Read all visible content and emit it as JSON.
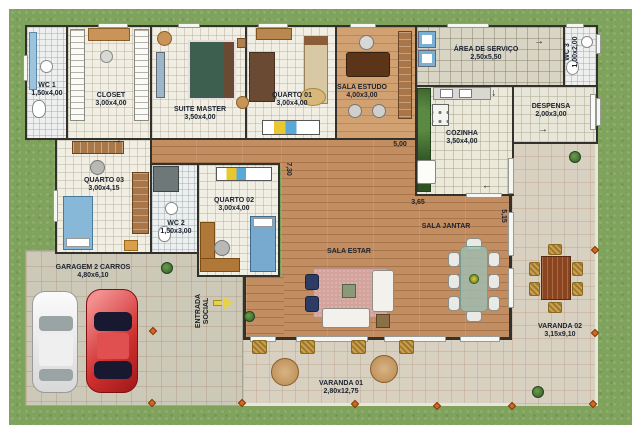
{
  "plan_type": "residential-floor-plan",
  "rooms": [
    {
      "id": "wc1",
      "name": "WC 1",
      "dims": "1,50x4,00"
    },
    {
      "id": "closet",
      "name": "CLOSET",
      "dims": "3,00x4,00"
    },
    {
      "id": "suite",
      "name": "SUITE MASTER",
      "dims": "3,50x4,00"
    },
    {
      "id": "quarto01",
      "name": "QUARTO 01",
      "dims": "3,00x4,00"
    },
    {
      "id": "estudo",
      "name": "SALA ESTUDO",
      "dims": "4,00x3,00"
    },
    {
      "id": "servico",
      "name": "ÁREA DE SERVIÇO",
      "dims": "2,50x5,50"
    },
    {
      "id": "wc3",
      "name": "WC 3",
      "dims": "1,00x2,00"
    },
    {
      "id": "despensa",
      "name": "DESPENSA",
      "dims": "2,00x3,00"
    },
    {
      "id": "cozinha",
      "name": "COZINHA",
      "dims": "3,50x4,00"
    },
    {
      "id": "quarto03",
      "name": "QUARTO 03",
      "dims": "3,00x4,15"
    },
    {
      "id": "wc2",
      "name": "WC 2",
      "dims": "1,50x3,00"
    },
    {
      "id": "quarto02",
      "name": "QUARTO 02",
      "dims": "3,00x4,00"
    },
    {
      "id": "garagem",
      "name": "GARAGEM 2 CARROS",
      "dims": "4,80x6,10"
    },
    {
      "id": "sala-estar",
      "name": "SALA ESTAR",
      "dims": ""
    },
    {
      "id": "sala-jantar",
      "name": "SALA JANTAR",
      "dims": ""
    },
    {
      "id": "varanda01",
      "name": "VARANDA 01",
      "dims": "2,80x12,75"
    },
    {
      "id": "varanda02",
      "name": "VARANDA 02",
      "dims": "3,15x9,10"
    }
  ],
  "annotations": {
    "dim_hall": "5,00",
    "dim_kitchen": "3,65",
    "dim_east": "5,15",
    "dim_west": "7,30",
    "entrance_line1": "ENTRADA",
    "entrance_line2": "SOCIAL"
  },
  "icons": {
    "door_arrow": "→"
  },
  "colors": {
    "grass": "#7fa35c",
    "wall": "#33312b",
    "wood_floor": "#c28d60",
    "room_floor": "#f1eee4",
    "pavement": "#cdc9b8",
    "veranda": "#d8d1c2",
    "rug": "#d4a49c",
    "car_red": "#d03030",
    "car_white": "#f2f2f2",
    "lamp_accent": "#d06820",
    "entry_arrow": "#e6d24a"
  }
}
